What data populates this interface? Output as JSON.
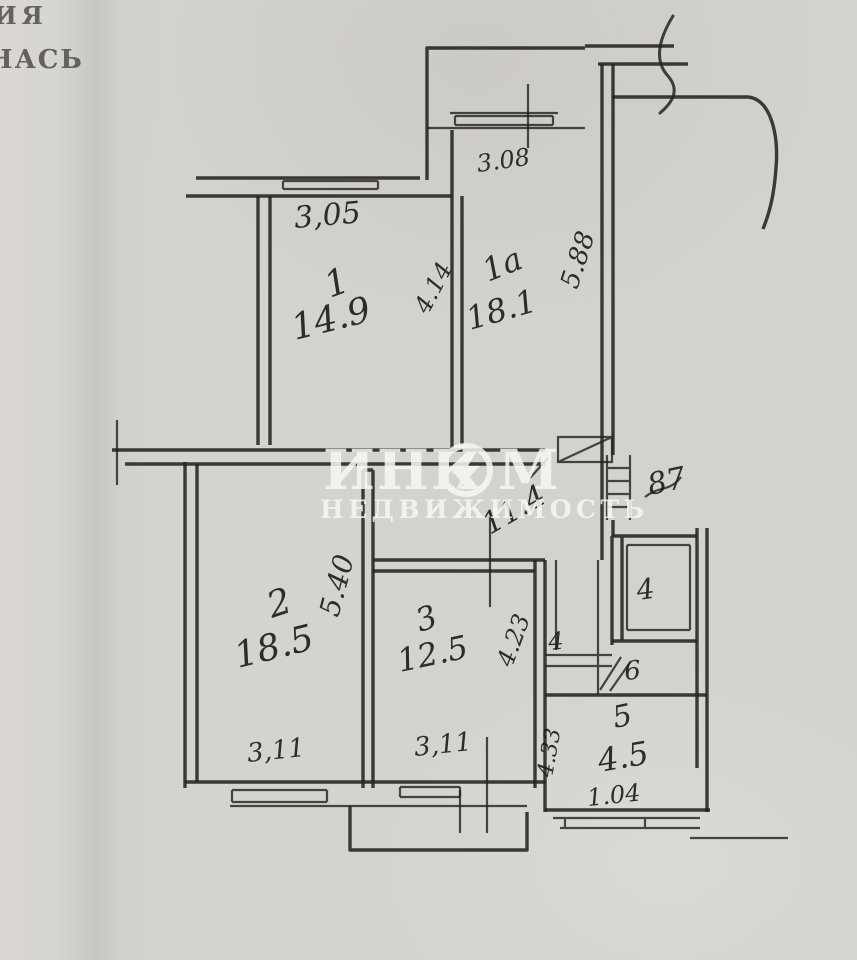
{
  "colors": {
    "paper": "#d4d2ce",
    "ink": "#26231f",
    "watermark": "#f8f7f4"
  },
  "stamp": {
    "line1": "ИЯ",
    "line2": "НАСЬ"
  },
  "watermark": {
    "part1": "ИНК",
    "part2": "М",
    "subtitle": "НЕДВИЖИМОСТЬ"
  },
  "hall": {
    "area": "11.4"
  },
  "annotations": {
    "scribble": "87"
  },
  "rooms": {
    "r1": {
      "number": "1",
      "area": "14.9",
      "diagonal": "4.14",
      "width": "3,05"
    },
    "r1a": {
      "number": "1а",
      "area": "18.1",
      "diagonal": "5.88",
      "balcony_width": "3.08"
    },
    "r2": {
      "number": "2",
      "area": "18.5",
      "diagonal": "5.40",
      "width": "3,11"
    },
    "r3": {
      "number": "3",
      "area": "12.5",
      "diagonal": "4.23",
      "width": "3,11"
    },
    "bath": {
      "number": "4"
    },
    "wc": {
      "number": "6"
    },
    "closet": {
      "number": "4"
    },
    "r5": {
      "number": "5",
      "area": "4.5",
      "width": "1.04",
      "height": "4.33"
    }
  }
}
